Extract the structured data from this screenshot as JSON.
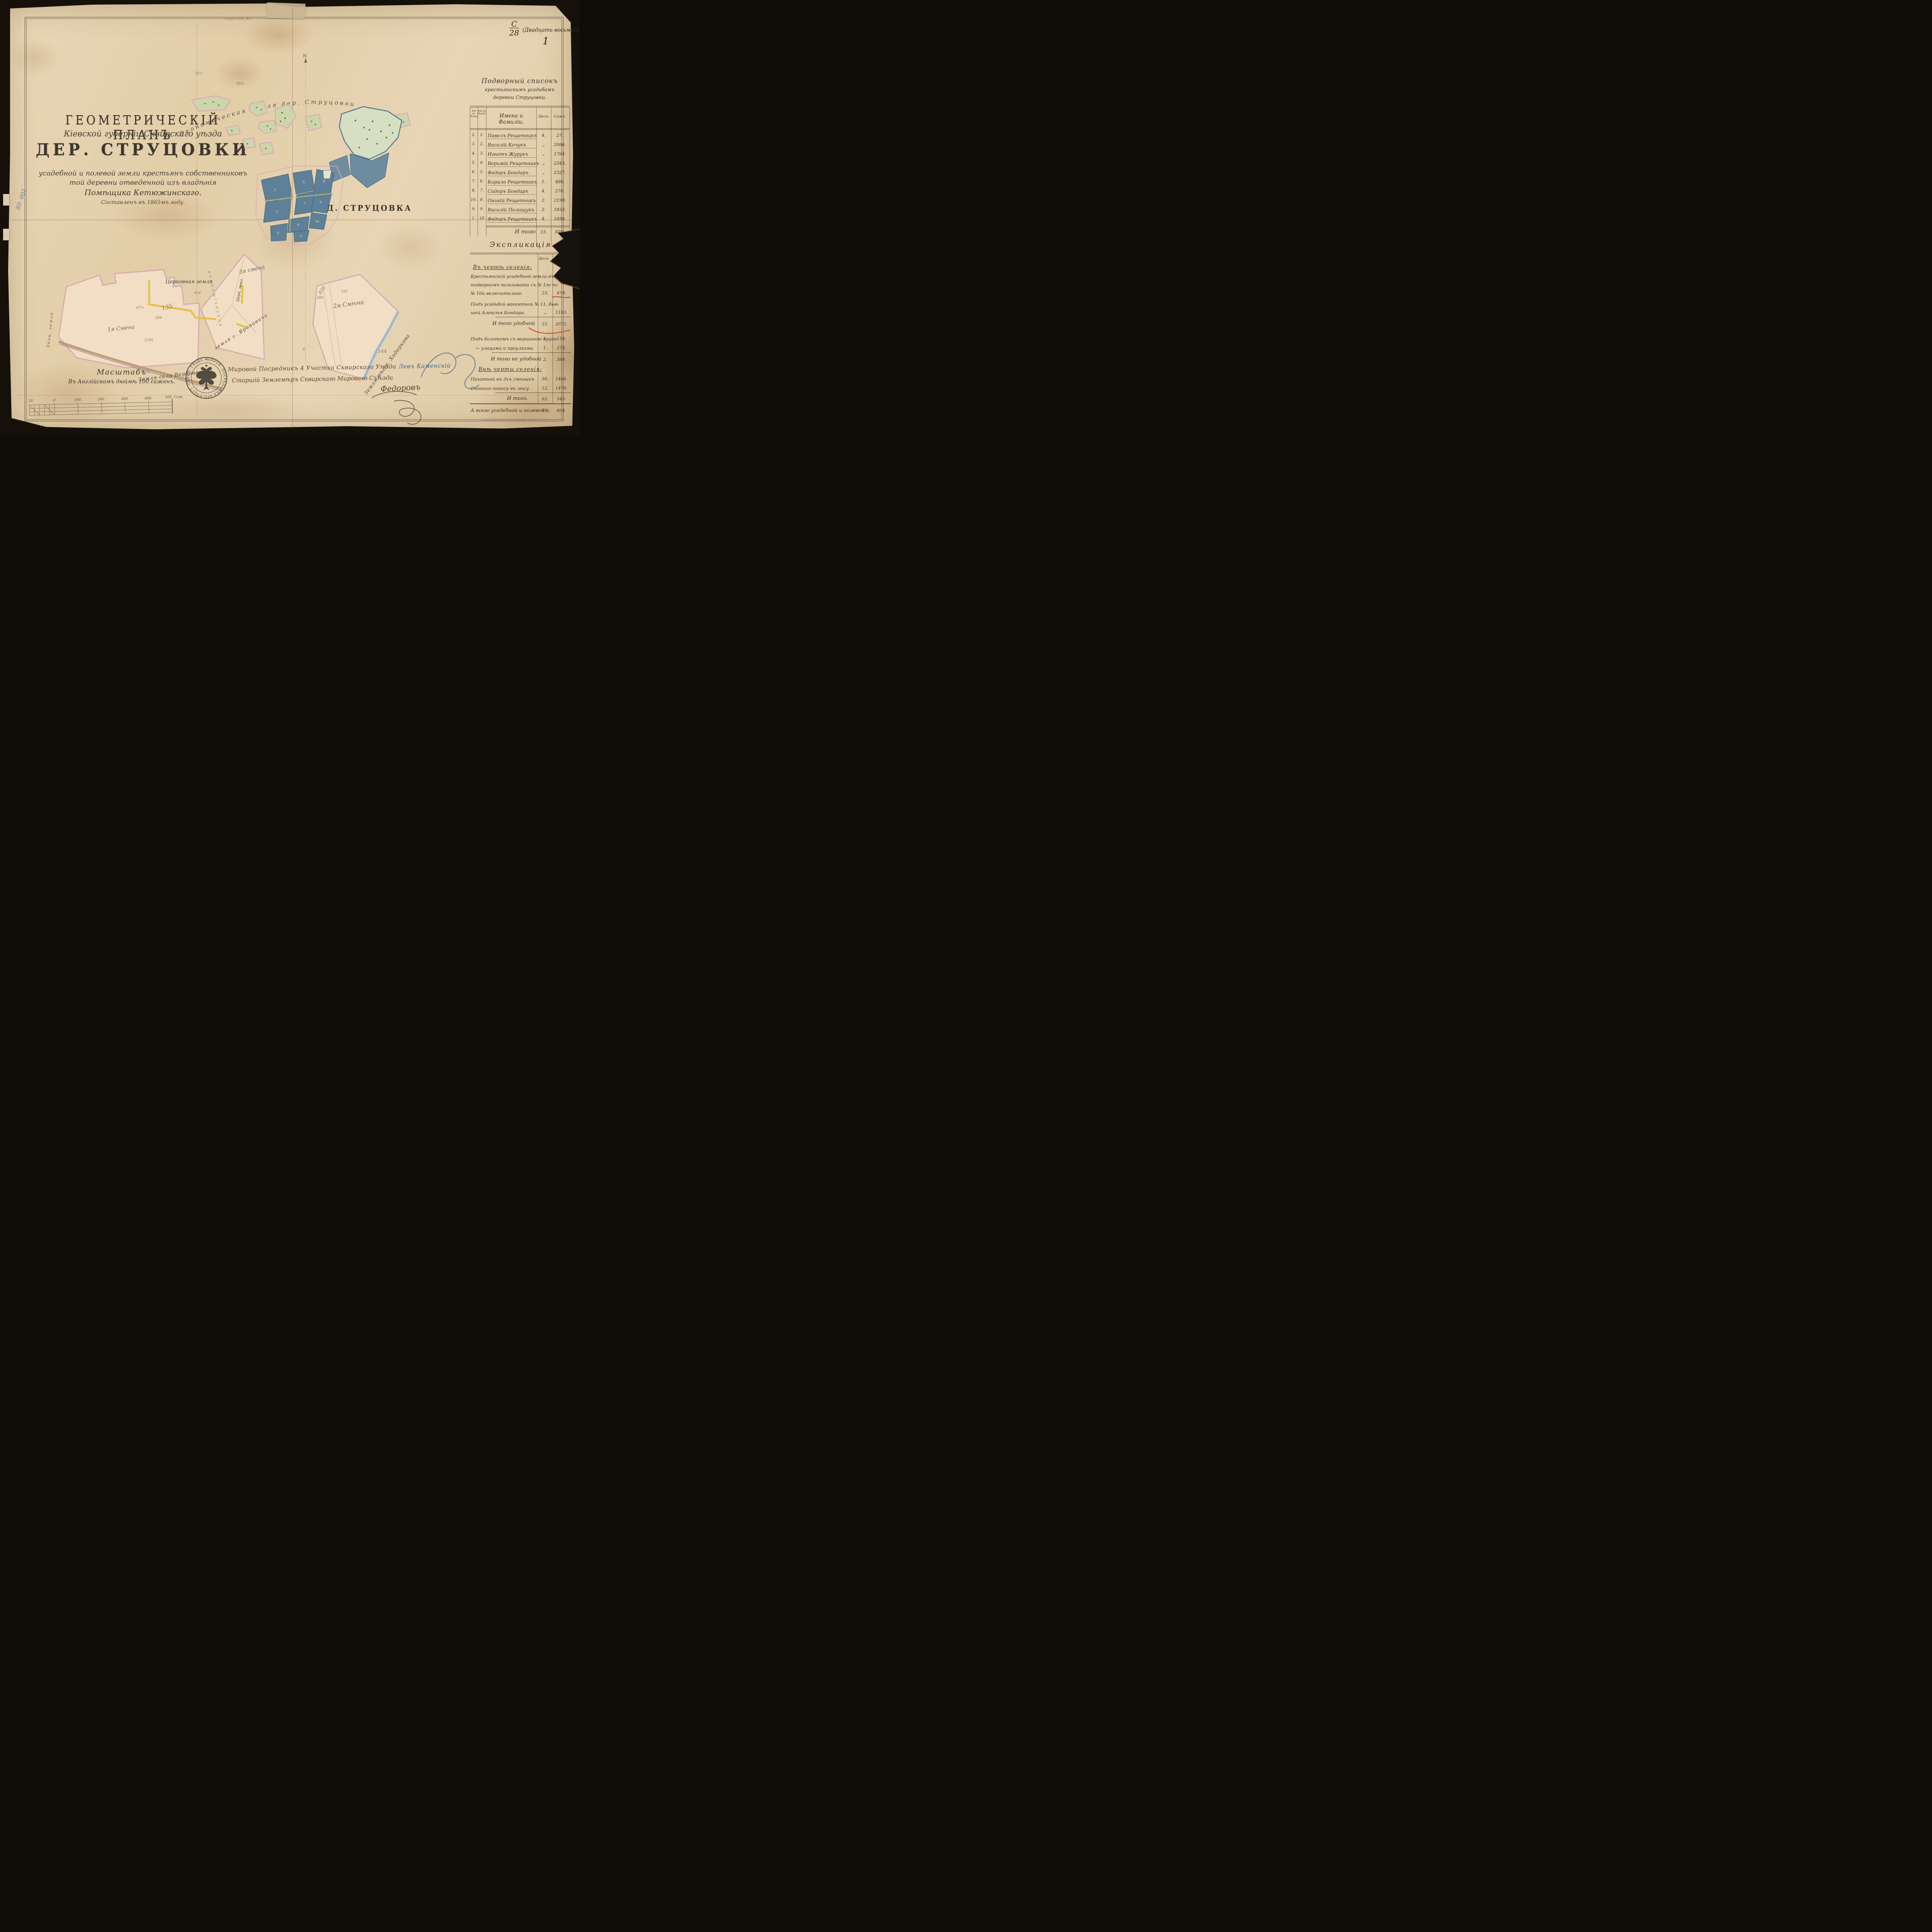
{
  "corner": {
    "code_top": "С",
    "code_bottom": "28",
    "code_note": "(Двадцать восьмой)",
    "page_number": "1"
  },
  "margin": {
    "blue_note": "89. 601",
    "top_pencil": "планъ дер. № 1"
  },
  "title": {
    "line1": "ГЕОМЕТРИЧЕСКІЙ ПЛАНЪ",
    "line2": "Кіевской губерніи Сквирскаго уѣзда",
    "line3": "ДЕР. СТРУЦОВКИ",
    "line4": "усадебной и полевой земли крестьянъ собственниковъ",
    "line5": "той деревни отведенной изъ владѣнія",
    "line6": "Помѣщика Кетюжинскаго.",
    "line7": "Составленъ въ 1865мъ году."
  },
  "map": {
    "arc_label": "Экономическая земля дер. Струцовки",
    "village_label": "Д. СТРУЦОВКА",
    "church_land": "Церковная земля",
    "church_land_small": "Церк. земл.",
    "smena1": "1я Смена",
    "smena2": "2я Смѣна",
    "smena3": "3я смена",
    "verbova": "Земля села Вербова",
    "khodorkova": "Земля мѣст. Ходоркова",
    "yaropovicha": "земля с. Яроповича",
    "strip_label": "економіческая",
    "econ_left": "Экон. земля",
    "compass_north": "N",
    "compass_south": "8",
    "plot_numbers": [
      "1",
      "2",
      "3",
      "4",
      "5",
      "6",
      "7",
      "8",
      "9",
      "10"
    ],
    "pencil_notes": [
      "76½",
      "90¼",
      "418",
      "135",
      "206",
      "850",
      "144",
      "326",
      "174",
      "2195",
      "47½",
      "286"
    ]
  },
  "roster": {
    "title1": "Подворный списокъ",
    "title2": "крестьянскимъ усадьбамъ",
    "title3": "деревни Струцовки.",
    "col_plan": "№№ по Плану.",
    "col_order": "№№ по Поряд.",
    "col_names": "Имена и Фамиліи.",
    "col_des": "Деся.",
    "col_saj": "Саже.",
    "rows": [
      {
        "plan": "2.",
        "order": "1.",
        "name": "Павелъ Рещетникъ",
        "des": "4.",
        "saj": "27."
      },
      {
        "plan": "3.",
        "order": "2.",
        "name": "Василій Кочукъ",
        "des": "„",
        "saj": "2086."
      },
      {
        "plan": "4.",
        "order": "3.",
        "name": "Игнатъ Журукъ",
        "des": "„",
        "saj": "1764."
      },
      {
        "plan": "5.",
        "order": "4.",
        "name": "Веримій Рещетникъ",
        "des": "„",
        "saj": "2343."
      },
      {
        "plan": "6.",
        "order": "5.",
        "name": "Федоръ Бондаръ",
        "des": "„",
        "saj": "2327."
      },
      {
        "plan": "7.",
        "order": "6.",
        "name": "Кирило Рещетникъ",
        "des": "1.",
        "saj": "480."
      },
      {
        "plan": "8.",
        "order": "7.",
        "name": "Сидоръ Бондаръ",
        "des": "4.",
        "saj": "270."
      },
      {
        "plan": "10.",
        "order": "8.",
        "name": "Оникій Рещетникъ",
        "des": "2.",
        "saj": "2199."
      },
      {
        "plan": "9.",
        "order": "9.",
        "name": "Василій Полищукъ",
        "des": "2.",
        "saj": "1833."
      },
      {
        "plan": "1.",
        "order": "10",
        "name": "Федоръ Рещетникъ",
        "des": "4.",
        "saj": "1950."
      }
    ],
    "total_label": "И того",
    "total_des": "23.",
    "total_saj": "879."
  },
  "explication": {
    "title": "Экспликація",
    "col_des": "Деся.",
    "items": [
      {
        "label": "Въ чертѣ селенія:"
      },
      {
        "lines": [
          "Крестьянской усадебной земли въ",
          "подворномъ пользованіи съ № 1го по",
          "№ 10й включительно."
        ],
        "des": "23.",
        "saj": "879."
      },
      {
        "lines": [
          "Подъ усадьбой вакантной № 11, быв-",
          "шей Алексѣя Бондара."
        ],
        "des": "„",
        "saj": "1193."
      },
      {
        "label": "И того удобной",
        "des": "23.",
        "saj": "2072."
      },
      {
        "lines": [
          "Подъ болотомъ съ вершиною пруда"
        ],
        "des": "1.",
        "saj": "116."
      },
      {
        "lines": [
          "— улицами и проулками"
        ],
        "des": "1.",
        "saj": "273."
      },
      {
        "label": "И того не удобной",
        "des": "2.",
        "saj": "389."
      },
      {
        "label": "Внѣ черты селенія:"
      },
      {
        "lines": [
          "Пахатной въ 3хъ смѣнахъ"
        ],
        "des": "50.",
        "saj": "1464."
      },
      {
        "lines": [
          "Сѣннаго покосу въ лѣсу"
        ],
        "des": "12.",
        "saj": "1479."
      },
      {
        "label": "И того.",
        "des": "63.",
        "saj": "543."
      },
      {
        "label": "А всего усадебной и полевой з.",
        "des": "89.",
        "saj": "604."
      },
      {
        "label": "усадебной и полевой земли",
        "des": "1—",
        "saj": "23."
      }
    ]
  },
  "scale": {
    "title": "Масштабъ",
    "subtitle": "Въ Англійскомъ дюймѣ 100 саженъ.",
    "ticks": [
      "20",
      "0",
      "100.",
      "200.",
      "300.",
      "400.",
      "500. Саж."
    ]
  },
  "seal": {
    "text": "МИРОВ. ПОСРЕДНИКА 4ГО УЧАСТ. СКВИР. УѢЗДА ✦"
  },
  "signatures": {
    "line1": "Мировой Посредникъ 4 Участка Сквирскаго Уѣзда",
    "line1_name": "Левъ Каменскій",
    "line2": "Старшій Землемѣръ Сквирскаго Мироваго Съѣзда",
    "name": "Федоровъ"
  }
}
